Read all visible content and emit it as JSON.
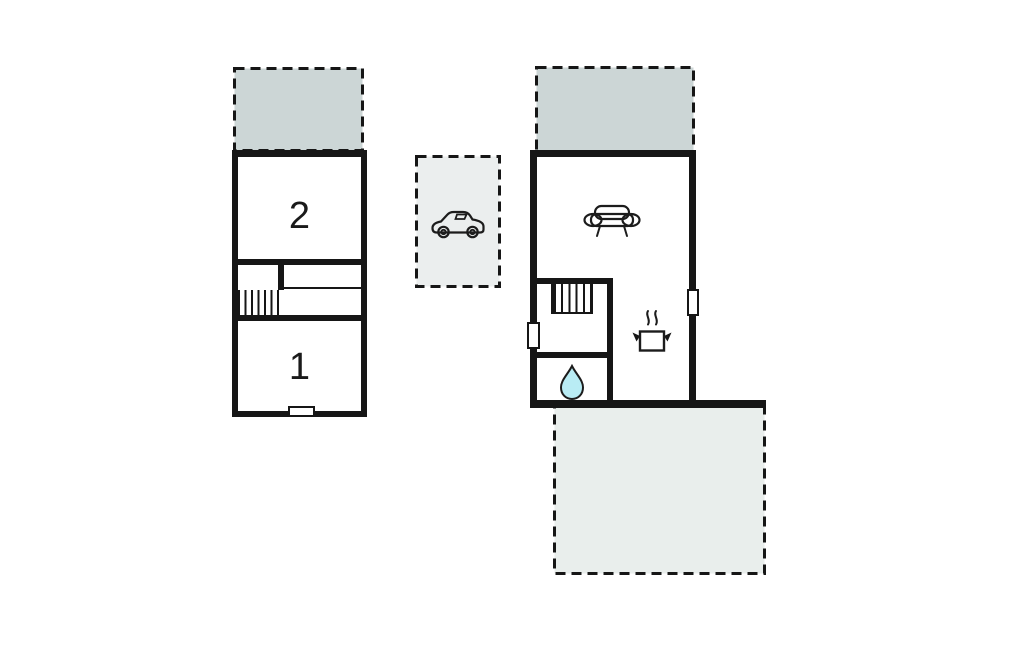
{
  "palette": {
    "background": "#ffffff",
    "wall": "#161616",
    "icon_stroke": "#1c1c1c",
    "shaded_terrace_fill": "#ccd6d6",
    "light_terrace_fill": "#e9eeec",
    "carport_fill": "#ebeeee",
    "water_drop_fill": "#b9ecf4"
  },
  "labels": {
    "room_upper": "2",
    "room_lower": "1"
  },
  "icons": [
    {
      "name": "car-icon",
      "area": "carport"
    },
    {
      "name": "sofa-icon",
      "area": "living-room"
    },
    {
      "name": "cooking-pot-icon",
      "area": "kitchen"
    },
    {
      "name": "water-drop-icon",
      "area": "bathroom"
    },
    {
      "name": "stairs",
      "area": "unit-left"
    },
    {
      "name": "stairs",
      "area": "unit-right"
    }
  ]
}
